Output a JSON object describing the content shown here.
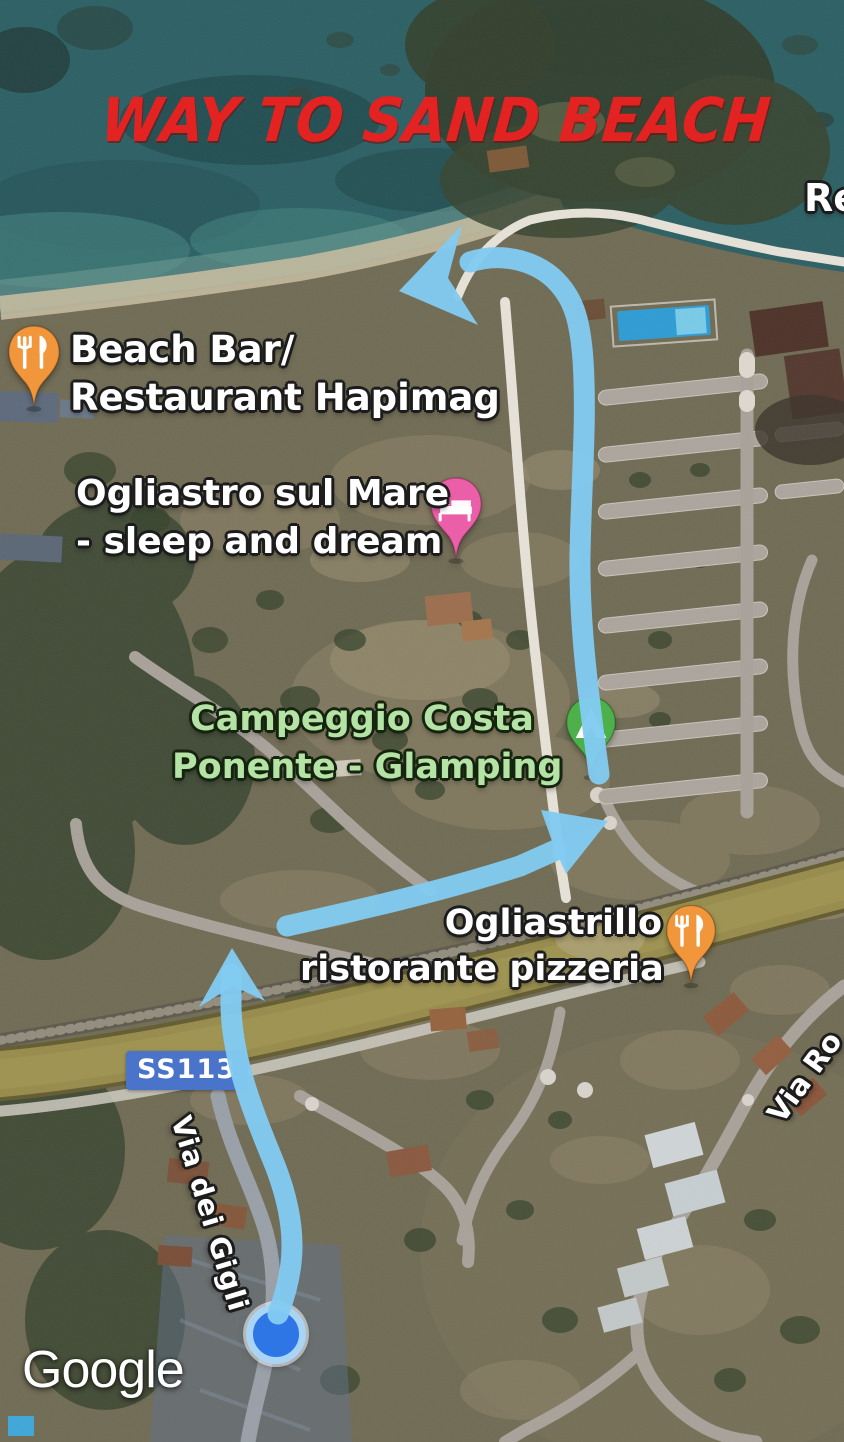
{
  "annotation": {
    "title": "WAY TO SAND BEACH",
    "title_color": "#e32222",
    "route_color": "#82cbf1",
    "route_description": "hand-drawn arrow path from location dot to the sand beach"
  },
  "attribution": {
    "logo_text": "Google"
  },
  "labels": {
    "road_badge": "SS113",
    "street_via_dei_gigli": "Via dei Gigli",
    "street_via_ro": "Via Ro",
    "partial_top_right": "Re"
  },
  "places": {
    "beach_bar": {
      "line1": "Beach Bar/",
      "line2": "Restaurant Hapimag",
      "category": "restaurant",
      "icon": "fork-knife-icon",
      "pin_color": "#f2963c",
      "text_color": "#ffffff"
    },
    "ogliastro": {
      "line1": "Ogliastro sul Mare",
      "line2": "- sleep and dream",
      "category": "lodging",
      "icon": "bed-icon",
      "pin_color": "#ea5fa8",
      "text_color": "#ffffff"
    },
    "campeggio": {
      "line1": "Campeggio Costa",
      "line2": "Ponente - Glamping",
      "category": "campground",
      "icon": "tent-icon",
      "pin_color": "#4db04a",
      "text_color": "#b5e3a5"
    },
    "ogliastrillo": {
      "line1": "Ogliastrillo",
      "line2": "ristorante pizzeria",
      "category": "restaurant",
      "icon": "fork-knife-icon",
      "pin_color": "#f2963c",
      "text_color": "#ffffff"
    }
  },
  "location_dot": {
    "color": "#2e76e6",
    "ring_color": "#a9d4f3"
  },
  "colors": {
    "badge_blue": "#4a74ca",
    "sea": "#2d6165",
    "beach_sand": "#c4bba0",
    "highway_yellow": "#978c4c",
    "road_gray": "#a8a29a",
    "terrain": "#716c55"
  }
}
